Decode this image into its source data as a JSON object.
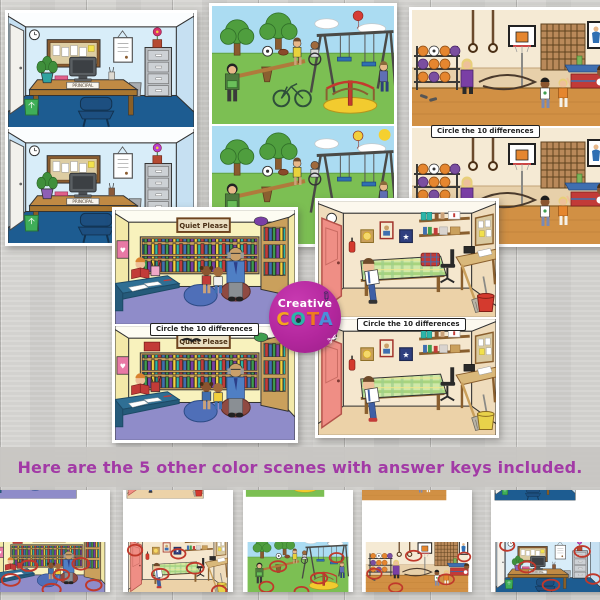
{
  "caption": {
    "text": "Here are the 5 other color scenes with answer keys included."
  },
  "labels": {
    "circle_differences": "Circle the 10 differences",
    "quiet_sign": "Quiet Please",
    "principal_nameplate": "PRINCIPAL"
  },
  "logo": {
    "top": "Creative",
    "letters": [
      "C",
      "O",
      "T",
      "A"
    ]
  },
  "colors": {
    "caption_text": "#a23aa6",
    "caption_band": "#c8c6c3",
    "logo_circle": "#b3279d",
    "answer_circle_red": "#c0392b",
    "wood_background": "#d2d1ce",
    "office_floor_blue": "#1d5c91",
    "library_floor_purple": "#8f8cc9",
    "gym_floor_tan": "#d19044",
    "playground_grass_green": "#7cbf53",
    "nurse_door_pink": "#ef8e85"
  }
}
